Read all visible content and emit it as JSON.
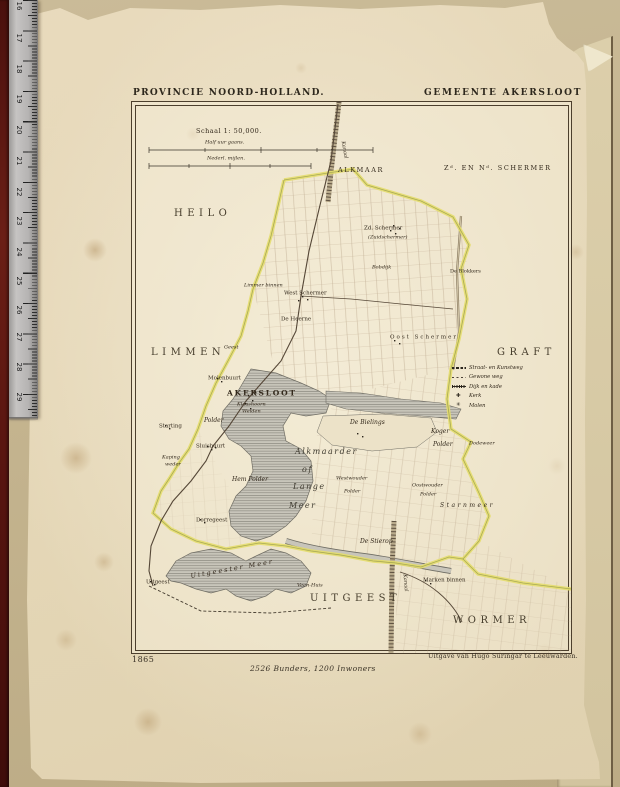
{
  "page": {
    "header_left": "PROVINCIE NOORD-HOLLAND.",
    "header_right": "GEMEENTE AKERSLOOT",
    "year": "1865",
    "stats": "2526 Bunders, 1200 Inwoners",
    "publisher": "Uitgave van Hugo Suringar te Leeuwarden."
  },
  "colors": {
    "paper": "#e9ddc1",
    "photo_background": "#c4b48f",
    "boundary_accent": "#e4dd6d",
    "water_grey": "#c8c5ba",
    "spine_maroon": "#581510",
    "ruler_grey": "#b5b3b2",
    "ink": "#33291c"
  },
  "ruler": {
    "numbers": [
      {
        "v": "16",
        "y": 2
      },
      {
        "v": "17",
        "y": 34
      },
      {
        "v": "18",
        "y": 65
      },
      {
        "v": "19",
        "y": 95
      },
      {
        "v": "20",
        "y": 126
      },
      {
        "v": "21",
        "y": 157
      },
      {
        "v": "22",
        "y": 188
      },
      {
        "v": "23",
        "y": 217
      },
      {
        "v": "24",
        "y": 248
      },
      {
        "v": "25",
        "y": 277
      },
      {
        "v": "26",
        "y": 306
      },
      {
        "v": "27",
        "y": 333
      },
      {
        "v": "28",
        "y": 363
      },
      {
        "v": "29",
        "y": 393
      }
    ]
  },
  "map": {
    "scale": {
      "title": "Schaal 1: 50,000.",
      "bar1_label": "Half uur gaans.",
      "bar2_label": "Nederl. mijlen."
    },
    "legend": {
      "items": [
        {
          "sym": "road-bold",
          "label": "Straat- en Kunstweg"
        },
        {
          "sym": "road-thin",
          "label": "Gewone weg"
        },
        {
          "sym": "dike",
          "label": "Dijk en kade"
        },
        {
          "sym": "church-icon",
          "label": "Kerk"
        },
        {
          "sym": "mill-icon",
          "label": "Molen"
        }
      ]
    },
    "labels": [
      {
        "text": "Schaal 1: 50,000.",
        "x": 64,
        "y": 29,
        "cls": "scaleT"
      },
      {
        "text": "Half uur gaans.",
        "x": 73,
        "y": 41,
        "cls": "tinyit"
      },
      {
        "text": "Nederl. mijlen.",
        "x": 75,
        "y": 57,
        "cls": "tinyit"
      },
      {
        "text": "Kanaal",
        "x": 203,
        "y": 48,
        "cls": "tinyit",
        "rot": 80
      },
      {
        "text": "ALKMAAR",
        "x": 206,
        "y": 68,
        "cls": "reg"
      },
      {
        "text": "Zᵈ. EN Nᵈ. SCHERMER",
        "x": 312,
        "y": 66,
        "cls": "reg"
      },
      {
        "text": "HEILO",
        "x": 42,
        "y": 112,
        "cls": "REG"
      },
      {
        "text": "Zd. Schermer",
        "x": 232,
        "y": 127,
        "cls": "vil"
      },
      {
        "text": "(Zuidschermer)",
        "x": 236,
        "y": 136,
        "cls": "tinyit"
      },
      {
        "text": "Bobdijk",
        "x": 240,
        "y": 166,
        "cls": "tinyit"
      },
      {
        "text": "De Blokkers",
        "x": 318,
        "y": 170,
        "cls": "tiny"
      },
      {
        "text": "Limmer binnen",
        "x": 112,
        "y": 184,
        "cls": "tinyit"
      },
      {
        "text": "West Schermer",
        "x": 152,
        "y": 192,
        "cls": "vil"
      },
      {
        "text": "De Heerne",
        "x": 149,
        "y": 218,
        "cls": "vil"
      },
      {
        "text": "Oost Schermer",
        "x": 258,
        "y": 236,
        "cls": "vil sp1"
      },
      {
        "text": "LIMMEN",
        "x": 19,
        "y": 251,
        "cls": "REG"
      },
      {
        "text": "GRAFT",
        "x": 365,
        "y": 251,
        "cls": "REG"
      },
      {
        "text": "Geest",
        "x": 92,
        "y": 246,
        "cls": "tinyit"
      },
      {
        "text": "Molenbuurt",
        "x": 76,
        "y": 277,
        "cls": "vil"
      },
      {
        "text": "AKERSLOOT",
        "x": 95,
        "y": 291,
        "cls": "town"
      },
      {
        "text": "Klaashoorn",
        "x": 105,
        "y": 303,
        "cls": "tinyit"
      },
      {
        "text": "Weiden",
        "x": 110,
        "y": 310,
        "cls": "tinyit"
      },
      {
        "text": "Polder",
        "x": 72,
        "y": 319,
        "cls": "it"
      },
      {
        "text": "Starting",
        "x": 27,
        "y": 325,
        "cls": "vil"
      },
      {
        "text": "Sluisbuurt",
        "x": 64,
        "y": 345,
        "cls": "vil"
      },
      {
        "text": "Kaping",
        "x": 30,
        "y": 356,
        "cls": "tinyit"
      },
      {
        "text": "weder",
        "x": 33,
        "y": 363,
        "cls": "tinyit"
      },
      {
        "text": "De Bielings",
        "x": 218,
        "y": 321,
        "cls": "it"
      },
      {
        "text": "Koger",
        "x": 299,
        "y": 330,
        "cls": "it"
      },
      {
        "text": "Polder",
        "x": 301,
        "y": 343,
        "cls": "it"
      },
      {
        "text": "Dodeweer",
        "x": 337,
        "y": 342,
        "cls": "tinyit"
      },
      {
        "text": "Alkmaarder",
        "x": 163,
        "y": 350,
        "cls": "meer"
      },
      {
        "text": "of",
        "x": 170,
        "y": 368,
        "cls": "meer"
      },
      {
        "text": "Lange",
        "x": 161,
        "y": 385,
        "cls": "meer"
      },
      {
        "text": "Meer",
        "x": 157,
        "y": 404,
        "cls": "meer"
      },
      {
        "text": "Hem Polder",
        "x": 100,
        "y": 378,
        "cls": "it"
      },
      {
        "text": "Westwouder",
        "x": 204,
        "y": 377,
        "cls": "tinyit"
      },
      {
        "text": "Polder",
        "x": 212,
        "y": 390,
        "cls": "tinyit"
      },
      {
        "text": "Oostwouder",
        "x": 280,
        "y": 384,
        "cls": "tinyit"
      },
      {
        "text": "Polder",
        "x": 288,
        "y": 393,
        "cls": "tinyit"
      },
      {
        "text": "Starnmeer",
        "x": 308,
        "y": 404,
        "cls": "it sp2"
      },
      {
        "text": "Dorregeest",
        "x": 64,
        "y": 419,
        "cls": "vil"
      },
      {
        "text": "De Stierop",
        "x": 228,
        "y": 440,
        "cls": "it"
      },
      {
        "text": "Uitgeester Meer",
        "x": 58,
        "y": 467,
        "cls": "meer2",
        "rot": -10
      },
      {
        "text": "Uitgeest",
        "x": 14,
        "y": 481,
        "cls": "vil"
      },
      {
        "text": "Veen-Huis",
        "x": 165,
        "y": 484,
        "cls": "tinyit"
      },
      {
        "text": "Marken binnen",
        "x": 291,
        "y": 479,
        "cls": "vil"
      },
      {
        "text": "Kanaal",
        "x": 264,
        "y": 481,
        "cls": "tinyit",
        "rot": 85
      },
      {
        "text": "UITGEEST",
        "x": 178,
        "y": 497,
        "cls": "REG"
      },
      {
        "text": "WORMER",
        "x": 321,
        "y": 519,
        "cls": "REG"
      }
    ]
  }
}
